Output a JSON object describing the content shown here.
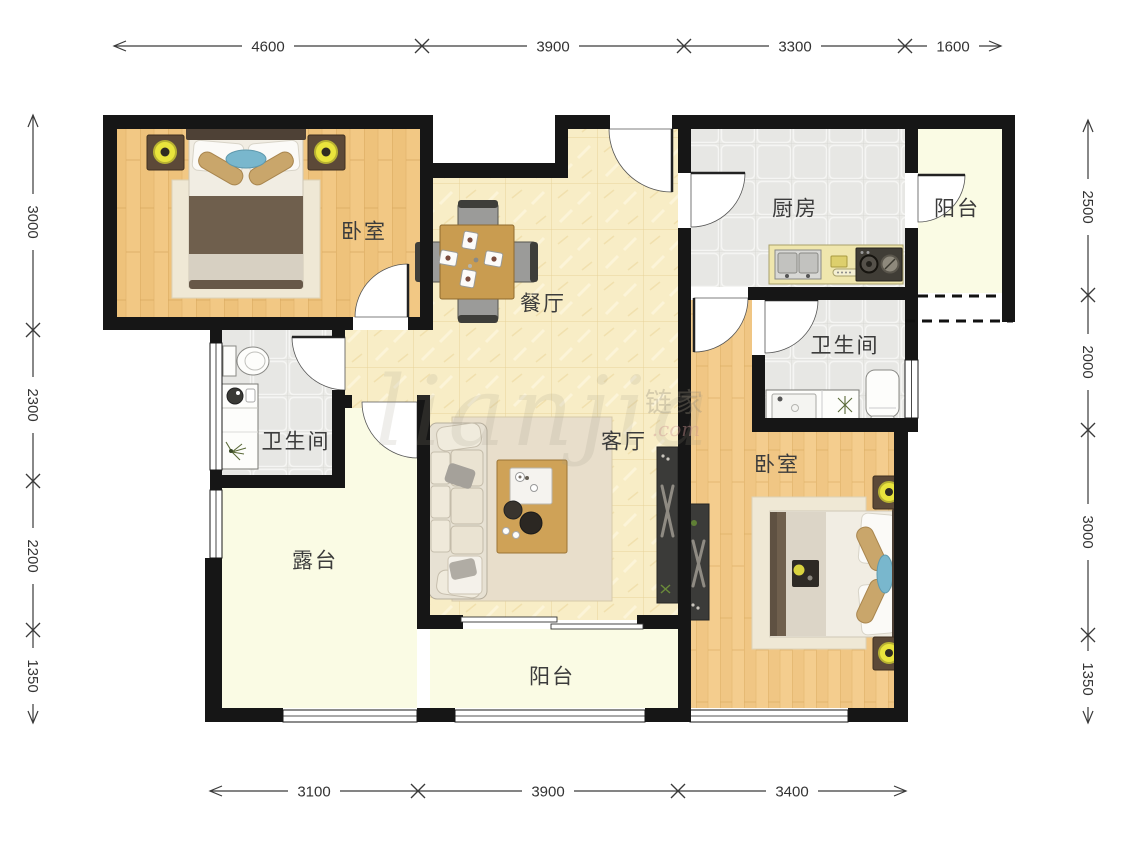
{
  "plan_title": "3室2厅户型图",
  "rooms": [
    {
      "id": "bedroom-top-left",
      "label": "卧室"
    },
    {
      "id": "dining-room",
      "label": "餐厅"
    },
    {
      "id": "kitchen",
      "label": "厨房"
    },
    {
      "id": "balcony-top-right",
      "label": "阳台"
    },
    {
      "id": "bathroom-right",
      "label": "卫生间"
    },
    {
      "id": "bedroom-right",
      "label": "卧室"
    },
    {
      "id": "living-room",
      "label": "客厅"
    },
    {
      "id": "bathroom-left",
      "label": "卫生间"
    },
    {
      "id": "terrace",
      "label": "露台"
    },
    {
      "id": "balcony-bottom",
      "label": "阳台"
    }
  ],
  "dims": {
    "top": [
      "4600",
      "3900",
      "3300",
      "1600"
    ],
    "left": [
      "3000",
      "2300",
      "2200",
      "1350"
    ],
    "right": [
      "2500",
      "2000",
      "3000",
      "1350"
    ],
    "bottom": [
      "3100",
      "3900",
      "3400"
    ]
  },
  "watermark": {
    "script": "lianjia",
    "cjk": "链家",
    "suffix": ".com"
  },
  "colors": {
    "wall": "#161616",
    "wood_floor": "#f2c884",
    "tile_warm": "#f8edc6",
    "tile_gray": "#eaeae7",
    "balcony_floor": "#fafbe4",
    "lamp_yellow": "#e9e43c",
    "accent_blue": "#79b7cd"
  }
}
